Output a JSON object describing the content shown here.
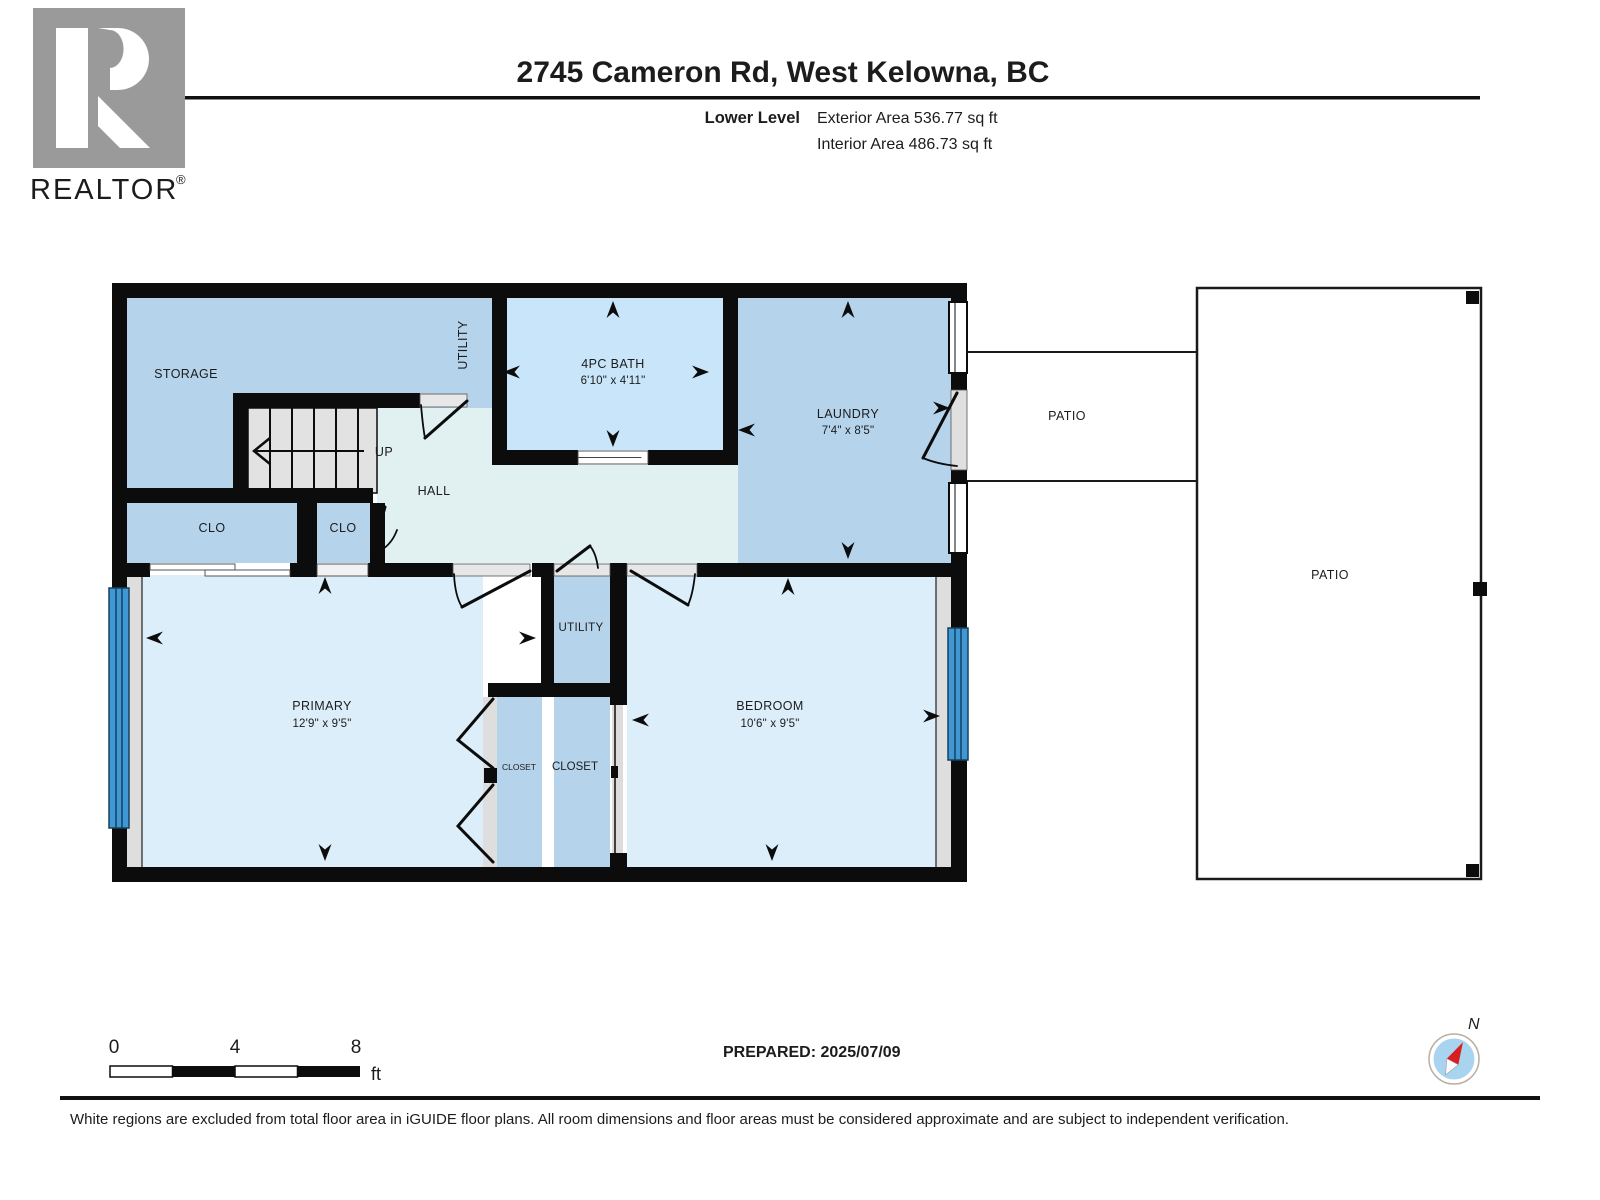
{
  "header": {
    "title": "2745 Cameron Rd, West Kelowna, BC",
    "level": "Lower Level",
    "exterior": "Exterior Area 536.77 sq ft",
    "interior": "Interior Area 486.73 sq ft"
  },
  "branding": {
    "realtor": "REALTOR",
    "reg": "®"
  },
  "rooms": {
    "storage": "STORAGE",
    "utility_side": "UTILITY",
    "bath": "4PC BATH",
    "bath_dims": "6'10\" x 4'11\"",
    "laundry": "LAUNDRY",
    "laundry_dims": "7'4\" x 8'5\"",
    "hall": "HALL",
    "up": "UP",
    "clo_left": "CLO",
    "clo_right": "CLO",
    "patio_near": "PATIO",
    "patio_far": "PATIO",
    "utility": "UTILITY",
    "primary": "PRIMARY",
    "primary_dims": "12'9\" x 9'5\"",
    "bedroom": "BEDROOM",
    "bedroom_dims": "10'6\" x 9'5\"",
    "closet_left": "CLOSET",
    "closet_right": "CLOSET"
  },
  "scale": {
    "t0": "0",
    "t4": "4",
    "t8": "8",
    "unit": "ft"
  },
  "compass": {
    "north": "N"
  },
  "meta": {
    "prepared": "PREPARED: 2025/07/09",
    "disclaimer": "White regions are excluded from total floor area in iGUIDE floor plans. All room dimensions and floor areas must be considered approximate and are subject to independent verification."
  },
  "colors": {
    "wall": "#0c0c0c",
    "room_medium": "#b5d3eb",
    "room_bath": "#c9e5f9",
    "room_light": "#ddeefb",
    "hall": "#e1f1f2",
    "window": "#3f97d3"
  }
}
